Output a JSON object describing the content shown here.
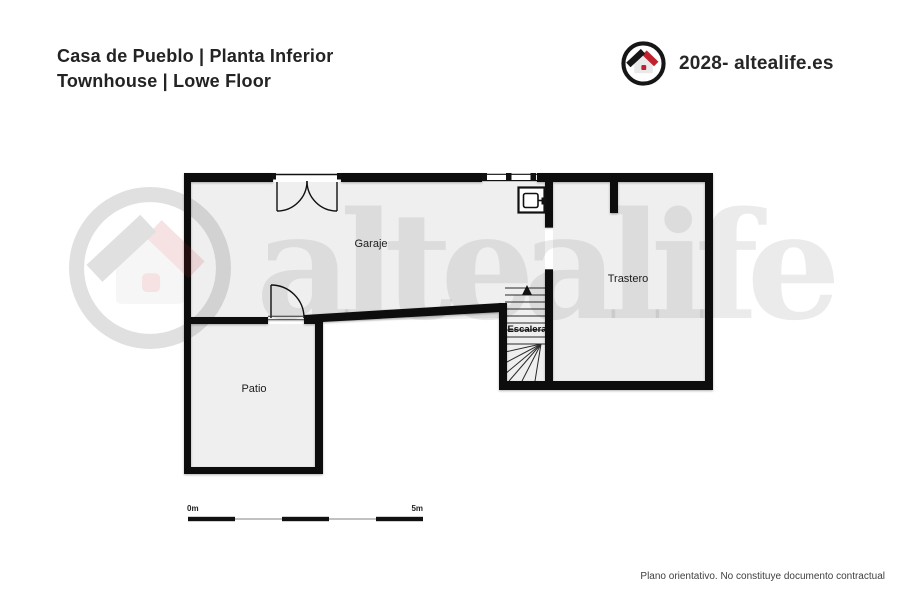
{
  "header": {
    "title_line1": "Casa de Pueblo | Planta Inferior",
    "title_line2": "Townhouse | Lowe Floor",
    "brand_text": "2028- altealife.es"
  },
  "watermark": {
    "text": "altealife"
  },
  "plan": {
    "rooms": [
      {
        "label": "Garaje"
      },
      {
        "label": "Trastero"
      },
      {
        "label": "Patio"
      },
      {
        "label": "Escalera"
      }
    ]
  },
  "scale_bar": {
    "start_label": "0m",
    "end_label": "5m"
  },
  "footer": {
    "disclaimer": "Plano orientativo. No constituye documento contractual"
  },
  "colors": {
    "wall": "#0d0d0d",
    "room_fill": "#efefef",
    "brand_red": "#c0212f",
    "brand_black": "#161616",
    "watermark_gray": "rgba(20,20,20,0.085)"
  },
  "icons": {
    "brand_logo": "house-in-circle-icon",
    "appliance": "water-heater-icon",
    "stairs_direction": "up-arrow-icon"
  }
}
